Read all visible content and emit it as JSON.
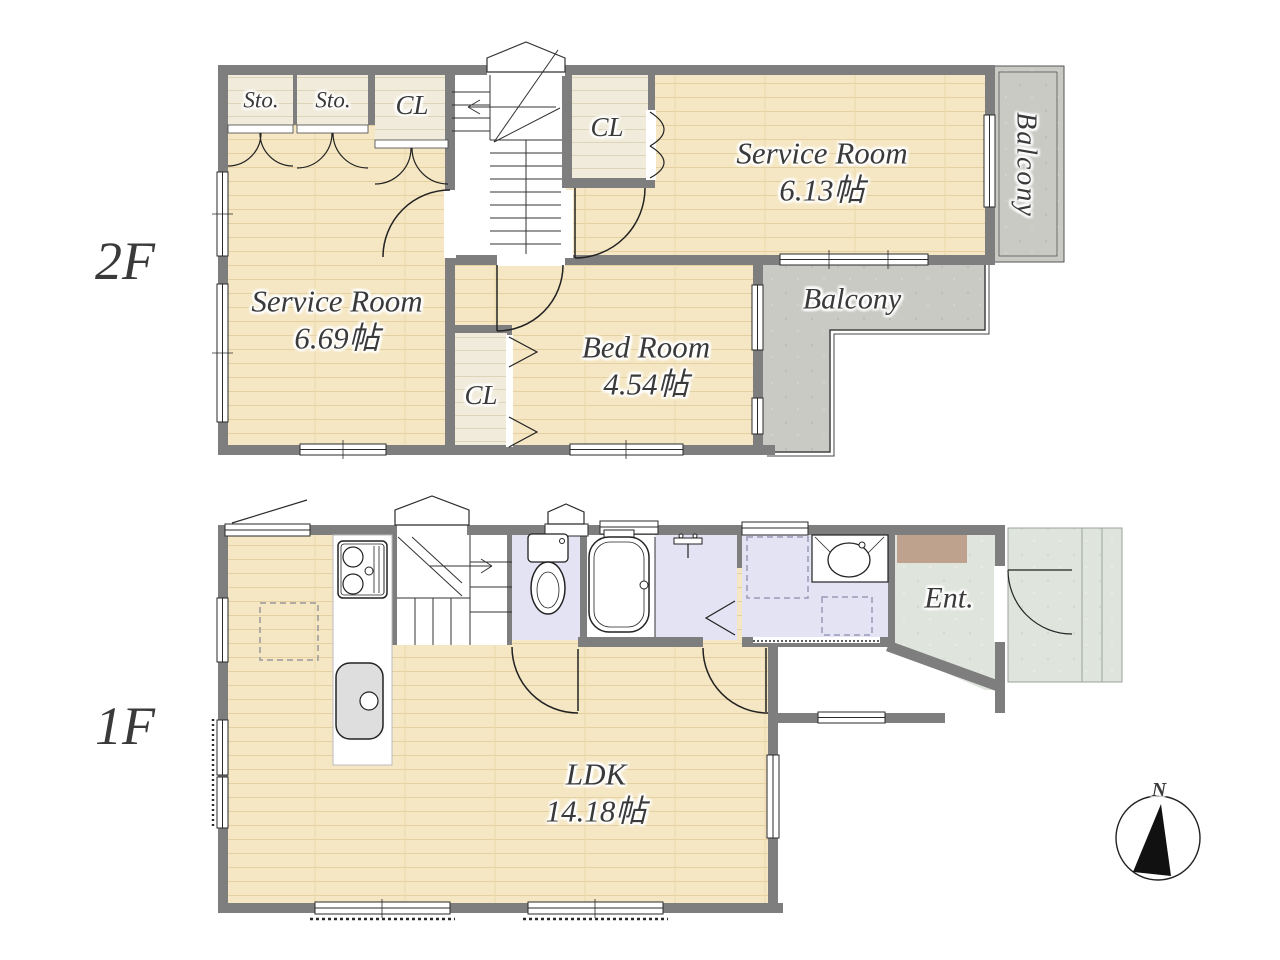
{
  "compass": {
    "north": "N"
  },
  "floor2": {
    "label": "2F",
    "storage_1": "Sto.",
    "storage_2": "Sto.",
    "closet_top": "CL",
    "closet_mid": "CL",
    "closet_bottom": "CL",
    "service_room_a": {
      "name": "Service Room",
      "area": "6.69帖"
    },
    "service_room_b": {
      "name": "Service Room",
      "area": "6.13帖"
    },
    "bed_room": {
      "name": "Bed Room",
      "area": "4.54帖"
    },
    "balcony_side": "Balcony",
    "balcony_rear": "Balcony"
  },
  "floor1": {
    "label": "1F",
    "ldk": {
      "name": "LDK",
      "area": "14.18帖"
    },
    "entrance": "Ent."
  },
  "colors": {
    "wall": "#7e7e7e",
    "wood_floor": "#f5e7c3",
    "closet_floor": "#f1ebdb",
    "balcony": "#c9cac4",
    "wet_area": "#e3e3f3",
    "entrance_floor": "#dfe4dc",
    "shoe_cabinet": "#bfa28e",
    "label_text": "#3a3a3a"
  }
}
